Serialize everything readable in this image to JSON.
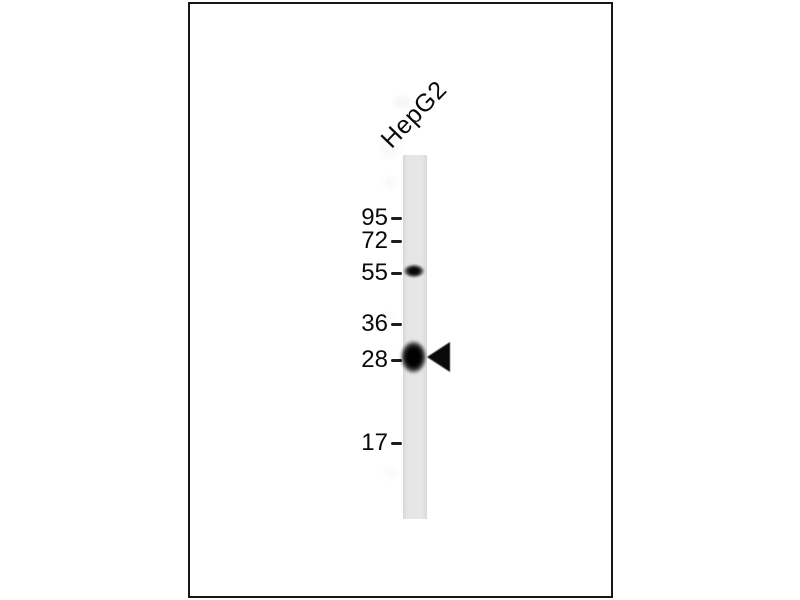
{
  "figure": {
    "type": "western-blot",
    "lane_label": "HepG2",
    "markers": [
      {
        "label": "95"
      },
      {
        "label": "72"
      },
      {
        "label": "55"
      },
      {
        "label": "36"
      },
      {
        "label": "28"
      },
      {
        "label": "17"
      }
    ],
    "bands": [
      {
        "near_marker": "55",
        "intensity": "weak"
      },
      {
        "near_marker": "28",
        "intensity": "strong",
        "marked_with_arrowhead": true
      }
    ],
    "colors": {
      "background": "#ffffff",
      "frame_border": "#161616",
      "lane_fill": "#e4e4e4",
      "band": "#0a0a0a",
      "text": "#0a0a0a"
    }
  }
}
